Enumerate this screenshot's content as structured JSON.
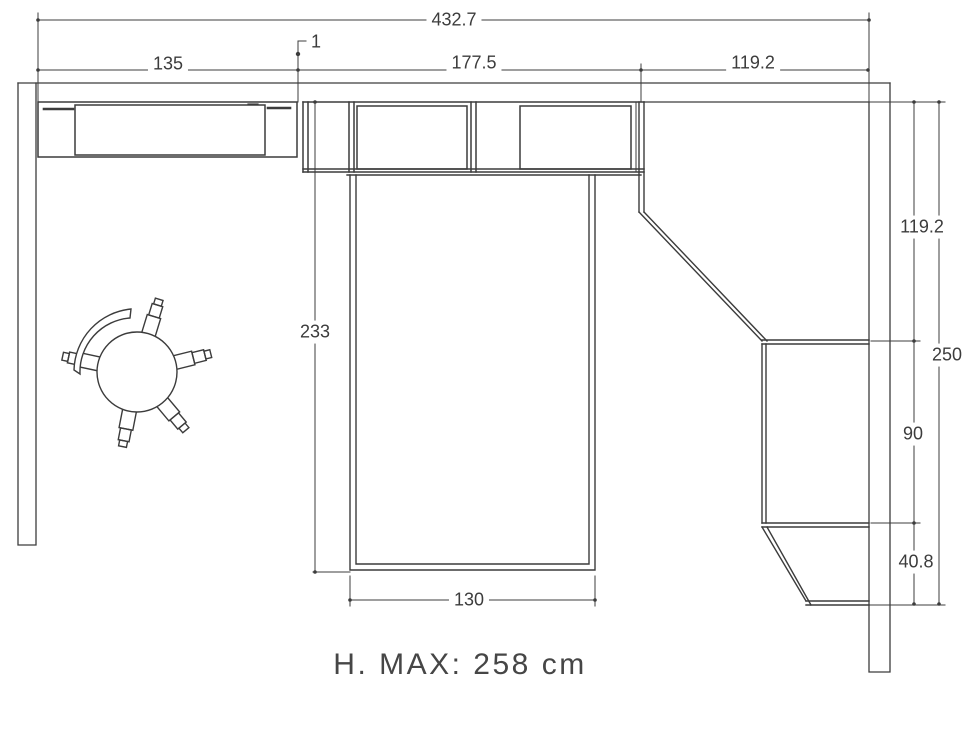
{
  "drawing": {
    "type": "furniture floor plan, top view",
    "line_color": "#3c3c3c",
    "background_color": "#ffffff",
    "unit": "cm"
  },
  "labels": {
    "total_width": "432.7",
    "desk_width": "135",
    "unit_gap": "1",
    "wardrobe_width": "177.5",
    "corner_section_width": "119.2",
    "right_depth_top": "119.2",
    "right_total_depth": "250",
    "right_depth_middle": "90",
    "right_depth_bottom": "40.8",
    "bed_depth": "233",
    "bed_width": "130",
    "max_height_note": "H. MAX: 258 cm"
  }
}
